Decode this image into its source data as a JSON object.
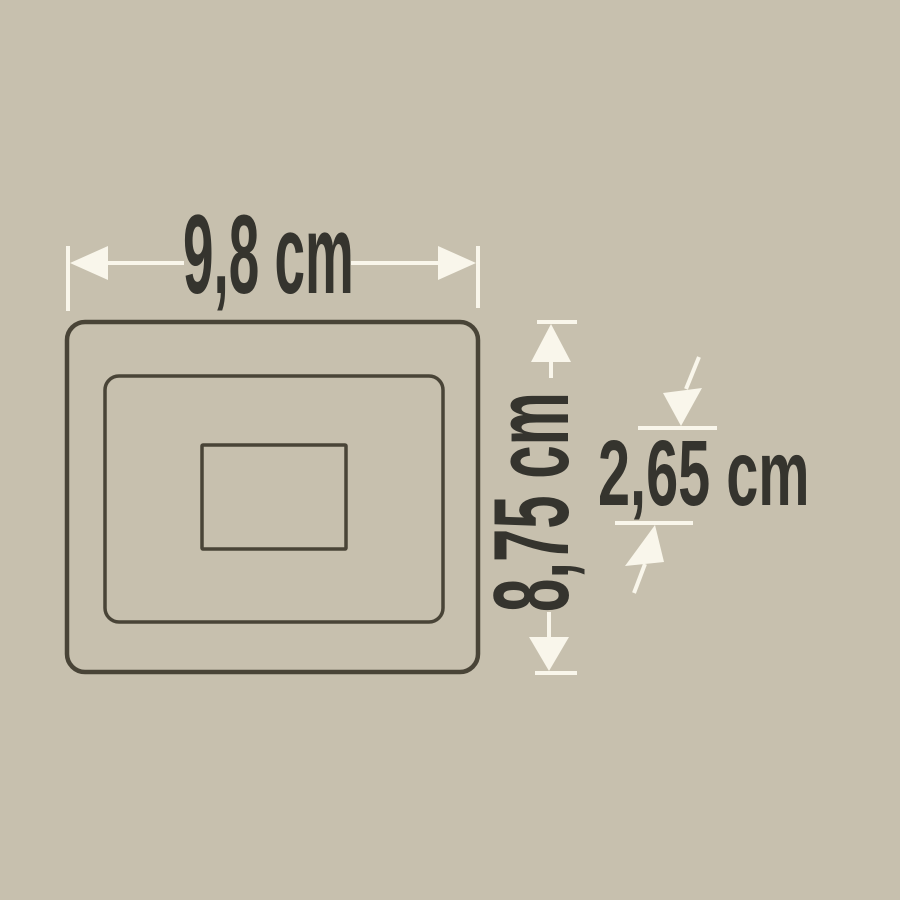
{
  "diagram": {
    "type": "product-dimension-drawing",
    "dimensions": {
      "width_label": "9,8 cm",
      "height_label": "8,75 cm",
      "depth_label": "2,65 cm"
    },
    "colors": {
      "background": "#c7c0ae",
      "outline": "#494437",
      "dimension_line": "#f9f6eb",
      "label_text": "#35342e"
    }
  }
}
